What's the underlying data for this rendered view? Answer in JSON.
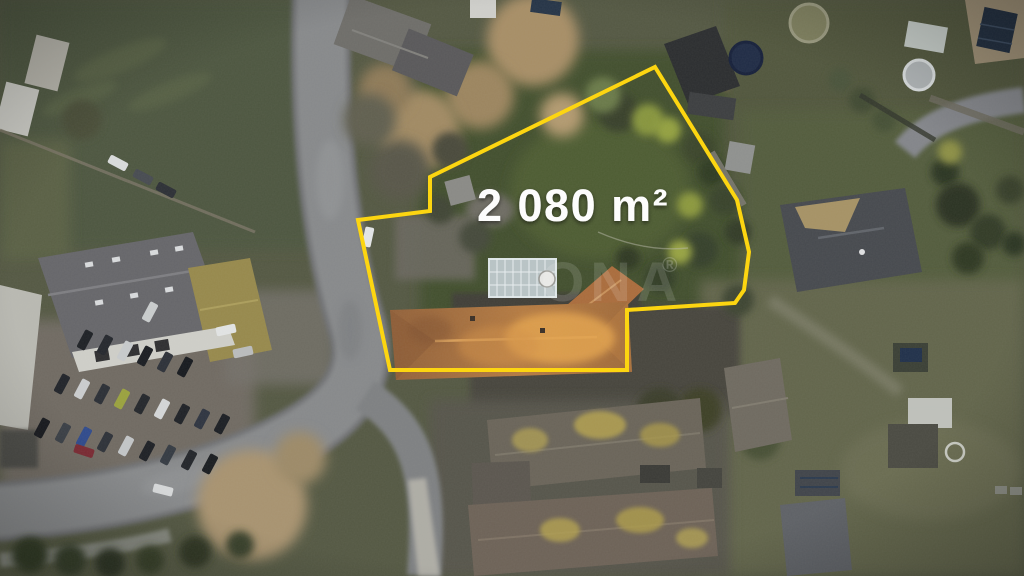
{
  "annotation": {
    "area_label": "2 080 m²",
    "text_color": "#ffffff"
  },
  "boundary": {
    "color": "#ffd60a",
    "stroke_width": "4",
    "points": "655,67 737,200 749,252 744,290 735,303 627,310 627,370 390,370 358,220 430,211 430,177"
  },
  "watermark": {
    "text": "ONA",
    "registered_mark": "®",
    "color": "#ffffff"
  },
  "scene": {
    "cars": [
      [
        85,
        340,
        -62,
        "#1d2025"
      ],
      [
        105,
        345,
        -62,
        "#24272d"
      ],
      [
        125,
        351,
        -62,
        "#c7cacc"
      ],
      [
        145,
        356,
        -62,
        "#1a1d22"
      ],
      [
        165,
        362,
        -62,
        "#2c3038"
      ],
      [
        185,
        367,
        -62,
        "#16191e"
      ],
      [
        62,
        384,
        -62,
        "#202329"
      ],
      [
        82,
        389,
        -62,
        "#caccce"
      ],
      [
        102,
        394,
        -62,
        "#2a2e35"
      ],
      [
        122,
        399,
        -62,
        "#9aa23e"
      ],
      [
        142,
        404,
        -62,
        "#23262b"
      ],
      [
        162,
        409,
        -62,
        "#d4d6d7"
      ],
      [
        182,
        414,
        -62,
        "#1e2126"
      ],
      [
        202,
        419,
        -62,
        "#2e3440"
      ],
      [
        222,
        424,
        -62,
        "#1b1e23"
      ],
      [
        42,
        428,
        -62,
        "#17191e"
      ],
      [
        63,
        433,
        -62,
        "#3a3f46"
      ],
      [
        84,
        437,
        -62,
        "#2f4a8c"
      ],
      [
        105,
        442,
        -62,
        "#2d3138"
      ],
      [
        126,
        446,
        -62,
        "#c2c5c7"
      ],
      [
        147,
        451,
        -62,
        "#1d2025"
      ],
      [
        168,
        455,
        -62,
        "#343a42"
      ],
      [
        189,
        460,
        -62,
        "#22252a"
      ],
      [
        210,
        464,
        -62,
        "#191c20"
      ],
      [
        118,
        163,
        28,
        "#d9dbdc"
      ],
      [
        143,
        177,
        28,
        "#474b51"
      ],
      [
        166,
        190,
        28,
        "#2c2f35"
      ],
      [
        84,
        451,
        18,
        "#7b2a33"
      ],
      [
        163,
        490,
        14,
        "#d6d8d9"
      ],
      [
        150,
        312,
        -62,
        "#c9cccd"
      ],
      [
        226,
        330,
        -12,
        "#e2e4e4"
      ],
      [
        243,
        352,
        -12,
        "#babcbd"
      ],
      [
        368,
        237,
        -78,
        "#e4e6e8"
      ]
    ],
    "trees": [
      [
        533,
        40,
        46,
        "#a78e66",
        8
      ],
      [
        480,
        95,
        34,
        "#9c855f",
        8
      ],
      [
        420,
        130,
        40,
        "#a18a63",
        8
      ],
      [
        385,
        90,
        26,
        "#8f7a58",
        8
      ],
      [
        562,
        115,
        22,
        "#b29a70",
        8
      ],
      [
        400,
        170,
        30,
        "#58564a",
        8
      ],
      [
        370,
        120,
        26,
        "#615f50",
        8
      ],
      [
        450,
        150,
        18,
        "#4a4a3a",
        4
      ],
      [
        440,
        210,
        14,
        "#3f4434",
        4
      ],
      [
        475,
        237,
        16,
        "#44483a",
        4
      ],
      [
        618,
        112,
        20,
        "#37412a",
        4
      ],
      [
        648,
        120,
        16,
        "#87953d",
        4
      ],
      [
        668,
        130,
        13,
        "#93a040",
        4
      ],
      [
        700,
        148,
        16,
        "#3a4429",
        4
      ],
      [
        712,
        172,
        14,
        "#2f3a24",
        4
      ],
      [
        725,
        200,
        15,
        "#38422b",
        4
      ],
      [
        690,
        205,
        13,
        "#8b983e",
        4
      ],
      [
        738,
        232,
        13,
        "#313b26",
        4
      ],
      [
        700,
        250,
        18,
        "#36402a",
        4
      ],
      [
        680,
        252,
        12,
        "#97a342",
        4
      ],
      [
        660,
        278,
        15,
        "#333d27",
        4
      ],
      [
        628,
        258,
        12,
        "#2f3923",
        4
      ],
      [
        610,
        296,
        12,
        "#38422c",
        4
      ],
      [
        603,
        95,
        18,
        "#6b7a4a",
        4
      ],
      [
        945,
        172,
        14,
        "#2c3522",
        4
      ],
      [
        958,
        205,
        22,
        "#2a3321",
        4
      ],
      [
        988,
        232,
        18,
        "#313b26",
        4
      ],
      [
        1010,
        190,
        14,
        "#37412b",
        4
      ],
      [
        968,
        258,
        16,
        "#2e3824",
        4
      ],
      [
        1014,
        244,
        12,
        "#2b3422",
        4
      ],
      [
        950,
        152,
        12,
        "#8c8f45",
        4
      ],
      [
        252,
        505,
        55,
        "#a8936f",
        8
      ],
      [
        300,
        458,
        26,
        "#9d8a68",
        8
      ],
      [
        82,
        120,
        20,
        "#4a4d38",
        4
      ],
      [
        30,
        555,
        18,
        "#2f3724",
        4
      ],
      [
        70,
        560,
        16,
        "#333b27",
        4
      ],
      [
        110,
        563,
        15,
        "#2b3322",
        4
      ],
      [
        150,
        560,
        14,
        "#343c28",
        4
      ],
      [
        195,
        552,
        16,
        "#2e3623",
        4
      ],
      [
        240,
        545,
        14,
        "#38402b",
        4
      ],
      [
        738,
        300,
        16,
        "#3d4430",
        4
      ],
      [
        700,
        410,
        22,
        "#3c4028",
        4
      ],
      [
        660,
        412,
        24,
        "#3a3e2c",
        4
      ],
      [
        760,
        440,
        20,
        "#474f36",
        4
      ],
      [
        840,
        80,
        12,
        "#49533a",
        4
      ],
      [
        862,
        100,
        13,
        "#3f4930",
        4
      ],
      [
        884,
        120,
        12,
        "#455036",
        4
      ]
    ]
  }
}
